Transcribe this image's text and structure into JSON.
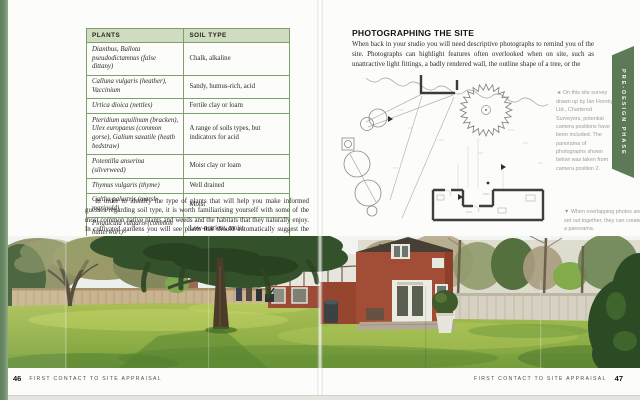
{
  "colors": {
    "table_border": "#7da06c",
    "table_header_bg": "#cfdcc0",
    "tab_bg": "#5c7a55",
    "edge_strip": "#5e7f5c",
    "caption": "#9aa096"
  },
  "left_page": {
    "table": {
      "headers": [
        "PLANTS",
        "SOIL TYPE"
      ],
      "rows": [
        {
          "plant": "Dianthus, Ballota pseudodictamnus (false dittany)",
          "soil": "Chalk, alkaline"
        },
        {
          "plant": "Calluna vulgaris (heather), Vaccinium",
          "soil": "Sandy, humus-rich, acid"
        },
        {
          "plant": "Urtica dioica (nettles)",
          "soil": "Fertile clay or loam"
        },
        {
          "plant": "Pteridium aquilinum (bracken), Ulex europaeus (common gorse), Galium saxatile (heath bedstraw)",
          "soil": "A range of soils types, but indicators for acid"
        },
        {
          "plant": "Potentilla anserina (silverweed)",
          "soil": "Moist clay or loam"
        },
        {
          "plant": "Thymus vulgaris (thyme)",
          "soil": "Well drained"
        },
        {
          "plant": "Caltha palustris (marsh marigold)",
          "soil": "Moist"
        },
        {
          "plant": "Pinguicula vulgaris (common butterwort)",
          "soil": "Low-nutrient, moist"
        }
      ]
    },
    "paragraph": "In order to identify the type of plants that will help you make informed guesses regarding soil type, it is worth familiarising yourself with some of the most common native plants and weeds and the habitats that they naturally enjoy. In cultivated gardens you will see plants that should automatically suggest the soil type to you, but if gardens are neglected or areas have not been cultivated for many years they may have reverted to the local native flora.",
    "footer": {
      "page_number": "46",
      "running_title": "FIRST CONTACT TO SITE APPRAISAL"
    }
  },
  "right_page": {
    "heading": "PHOTOGRAPHING THE SITE",
    "body": "When back in your studio you will need descriptive photographs to remind you of the site. Photographs can highlight features often overlooked when on site, such as unattractive light fittings, a badly rendered wall, the outline shape of a tree, or the",
    "captions": {
      "survey": "◄ On this site survey drawn up by Ian Hornby Ltd., Chartered Surveyors, potential camera positions have been included. The panorama of photographs shown below was taken from camera position 2.",
      "panorama": "▼ When overlapping photos are set out together, they can create a panorama."
    },
    "side_tab": "PRE-DESIGN PHASE",
    "footer": {
      "page_number": "47",
      "running_title": "FIRST CONTACT TO SITE APPRAISAL"
    }
  }
}
